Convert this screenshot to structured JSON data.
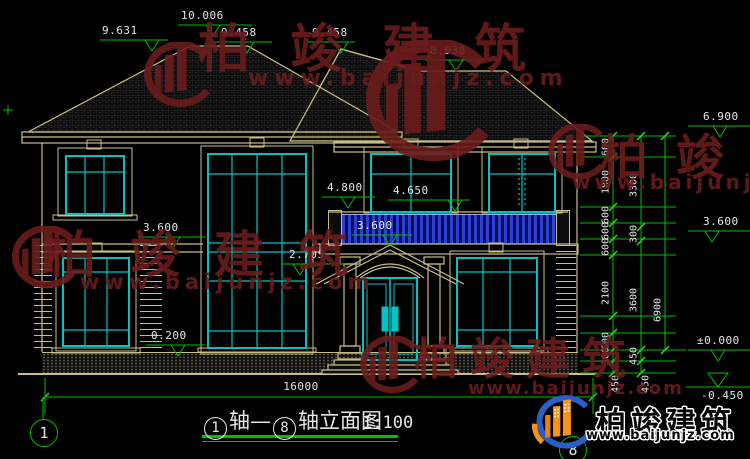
{
  "brand": {
    "name": "柏竣建筑",
    "site": "www.baijunjz.com"
  },
  "title": {
    "axis_a": "1",
    "sep": "轴—",
    "axis_b": "8",
    "suffix": "轴立面图",
    "scale": "1:100"
  },
  "axis": {
    "left": "1",
    "right": "8"
  },
  "levels": {
    "roof_left": "9.631",
    "ridge": "10.006",
    "hip_a": "9.458",
    "hip_b": "9.458",
    "roof_right": "8.938",
    "eave": "6.900",
    "balcony_door": "4.800",
    "win_head": "4.650",
    "f2_mid": "3.600",
    "f2_left": "3.600",
    "f2_right": "3.600",
    "porch": "2.705",
    "plinth": "0.200",
    "zero": "±0.000",
    "ground": "-0.450"
  },
  "dims": {
    "total": "16000",
    "c1": [
      "600",
      "1800",
      "600",
      "600",
      "600",
      "2100",
      "600",
      "300",
      "450"
    ],
    "c2": [
      "3300",
      "300",
      "3600",
      "450",
      "450"
    ],
    "c3": [
      "6900"
    ]
  }
}
